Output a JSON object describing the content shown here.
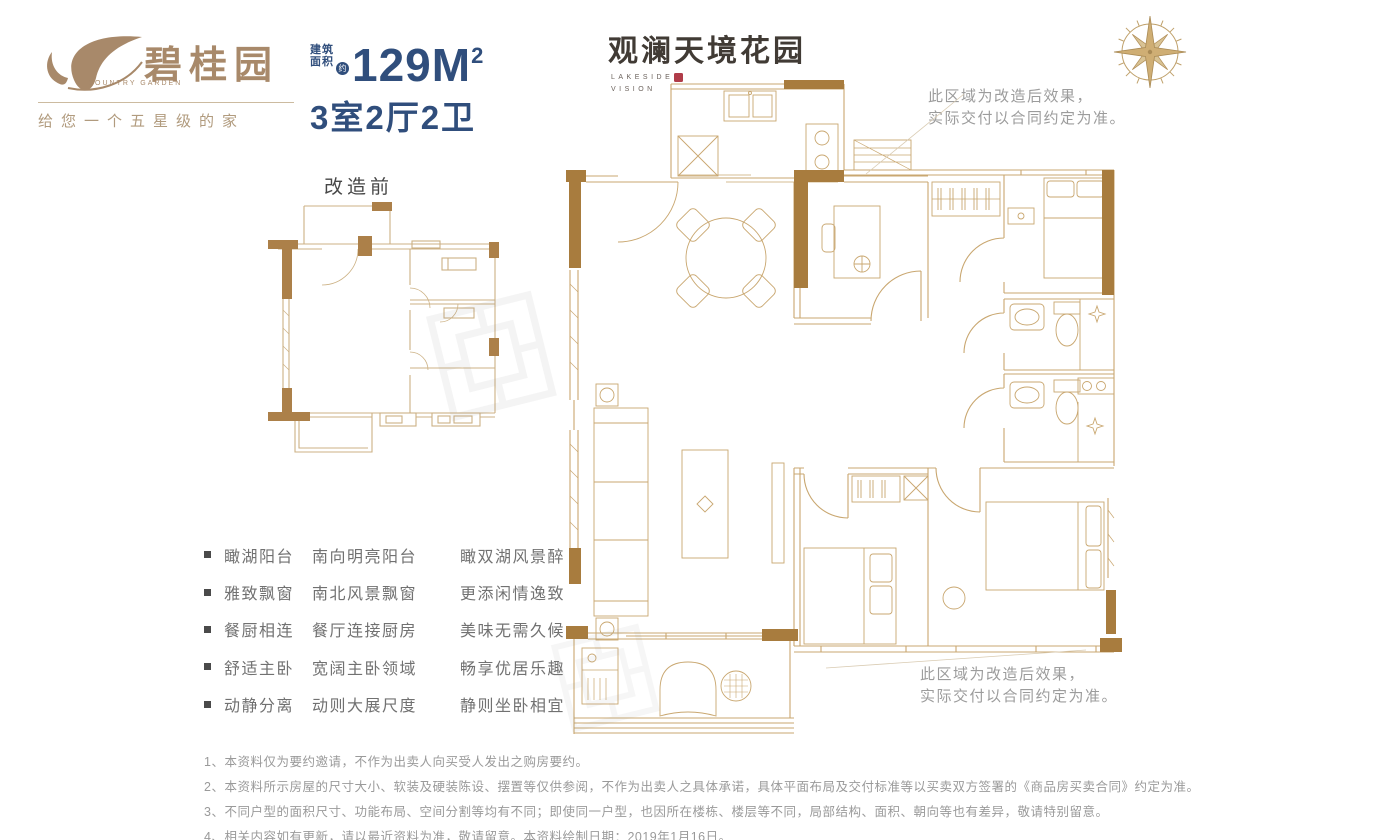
{
  "brand": {
    "name_cn": "碧桂园",
    "name_en": "COUNTRY GARDEN",
    "tagline": "给您一个五星级的家"
  },
  "unit": {
    "area_label_top": "建筑",
    "area_label_bottom": "面积",
    "approx_badge": "约",
    "area_value": "129M",
    "area_exponent": "2",
    "rooms": "3室2厅2卫"
  },
  "project": {
    "name": "观澜天境花园",
    "sub_top": "LAKESIDE",
    "sub_bottom": "VISION"
  },
  "plan": {
    "before_label": "改造前"
  },
  "notes": {
    "top_line1": "此区域为改造后效果，",
    "top_line2": "实际交付以合同约定为准。",
    "bottom_line1": "此区域为改造后效果，",
    "bottom_line2": "实际交付以合同约定为准。"
  },
  "features": {
    "rows": [
      {
        "title": "瞰湖阳台",
        "d1": "南向明亮阳台",
        "d2": "瞰双湖风景醉"
      },
      {
        "title": "雅致飘窗",
        "d1": "南北风景飘窗",
        "d2": "更添闲情逸致"
      },
      {
        "title": "餐厨相连",
        "d1": "餐厅连接厨房",
        "d2": "美味无需久候"
      },
      {
        "title": "舒适主卧",
        "d1": "宽阔主卧领域",
        "d2": "畅享优居乐趣"
      },
      {
        "title": "动静分离",
        "d1": "动则大展尺度",
        "d2": "静则坐卧相宜"
      }
    ]
  },
  "disclaimers": [
    "1、本资料仅为要约邀请，不作为出卖人向买受人发出之购房要约。",
    "2、本资料所示房屋的尺寸大小、软装及硬装陈设、摆置等仅供参阅，不作为出卖人之具体承诺，具体平面布局及交付标准等以买卖双方签署的《商品房买卖合同》约定为准。",
    "3、不同户型的面积尺寸、功能布局、空间分割等均有不同；即使同一户型，也因所在楼栋、楼层等不同，局部结构、面积、朝向等也有差异，敬请特别留意。",
    "4、相关内容如有更新，请以最近资料为准，敬请留意。本资料绘制日期：2019年1月16日。"
  ],
  "colors": {
    "accent_navy": "#304e7c",
    "wall_brown": "#a87c3e",
    "plan_line": "#c9a770",
    "brand_tan": "#a8896a",
    "seal_red": "#b03c49"
  }
}
